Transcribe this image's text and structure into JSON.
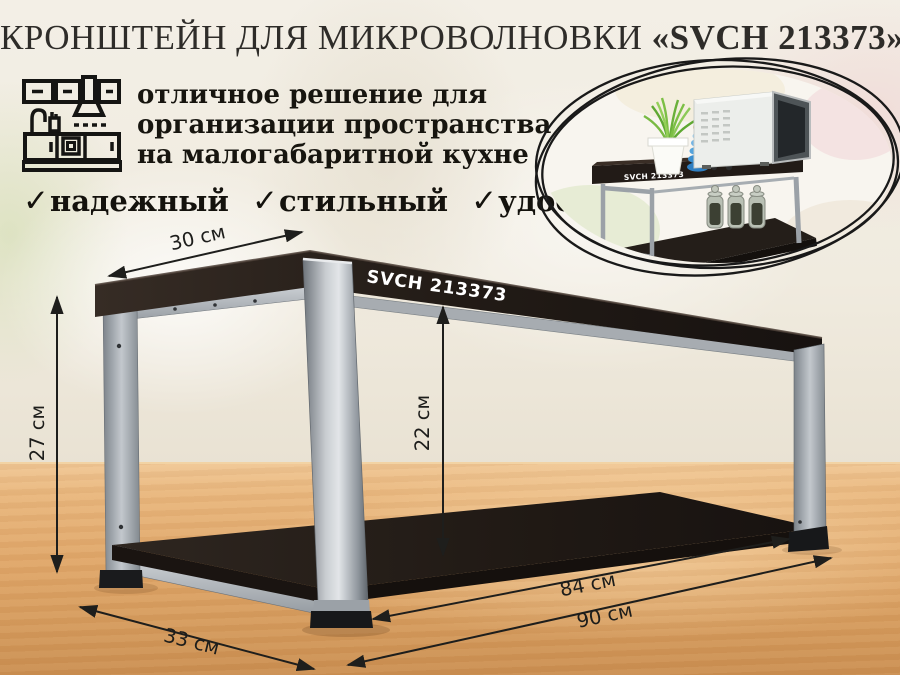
{
  "header": {
    "title_main": "КРОНШТЕЙН ДЛЯ МИКРОВОЛНОВКИ ",
    "title_model": "«SVCH 213373»"
  },
  "intro": {
    "lines": [
      "отличное решение для",
      "организации пространства",
      "на малогабаритной кухне"
    ]
  },
  "features": {
    "checkmark": "✓",
    "items": [
      "надежный",
      "стильный",
      "удобный"
    ]
  },
  "product": {
    "label": "SVCH 213373"
  },
  "inset": {
    "label": "SVCH 213373"
  },
  "dimensions": {
    "top_depth": "30 см",
    "height": "27 см",
    "clearance": "22 см",
    "inner_length": "84 см",
    "length": "90 см",
    "bottom_depth": "33 см"
  },
  "icons": {
    "kitchen": "kitchen-line-icon",
    "checkmark_glyph": "✓"
  },
  "colors": {
    "shelf_dark_wood": "#241d19",
    "metal_silver": "#b9bdc2",
    "table_wood": "#e0a76a",
    "wall_cream": "#f0ebdf",
    "text_dark": "#1c1b18",
    "annotation": "#1e1e1c"
  }
}
